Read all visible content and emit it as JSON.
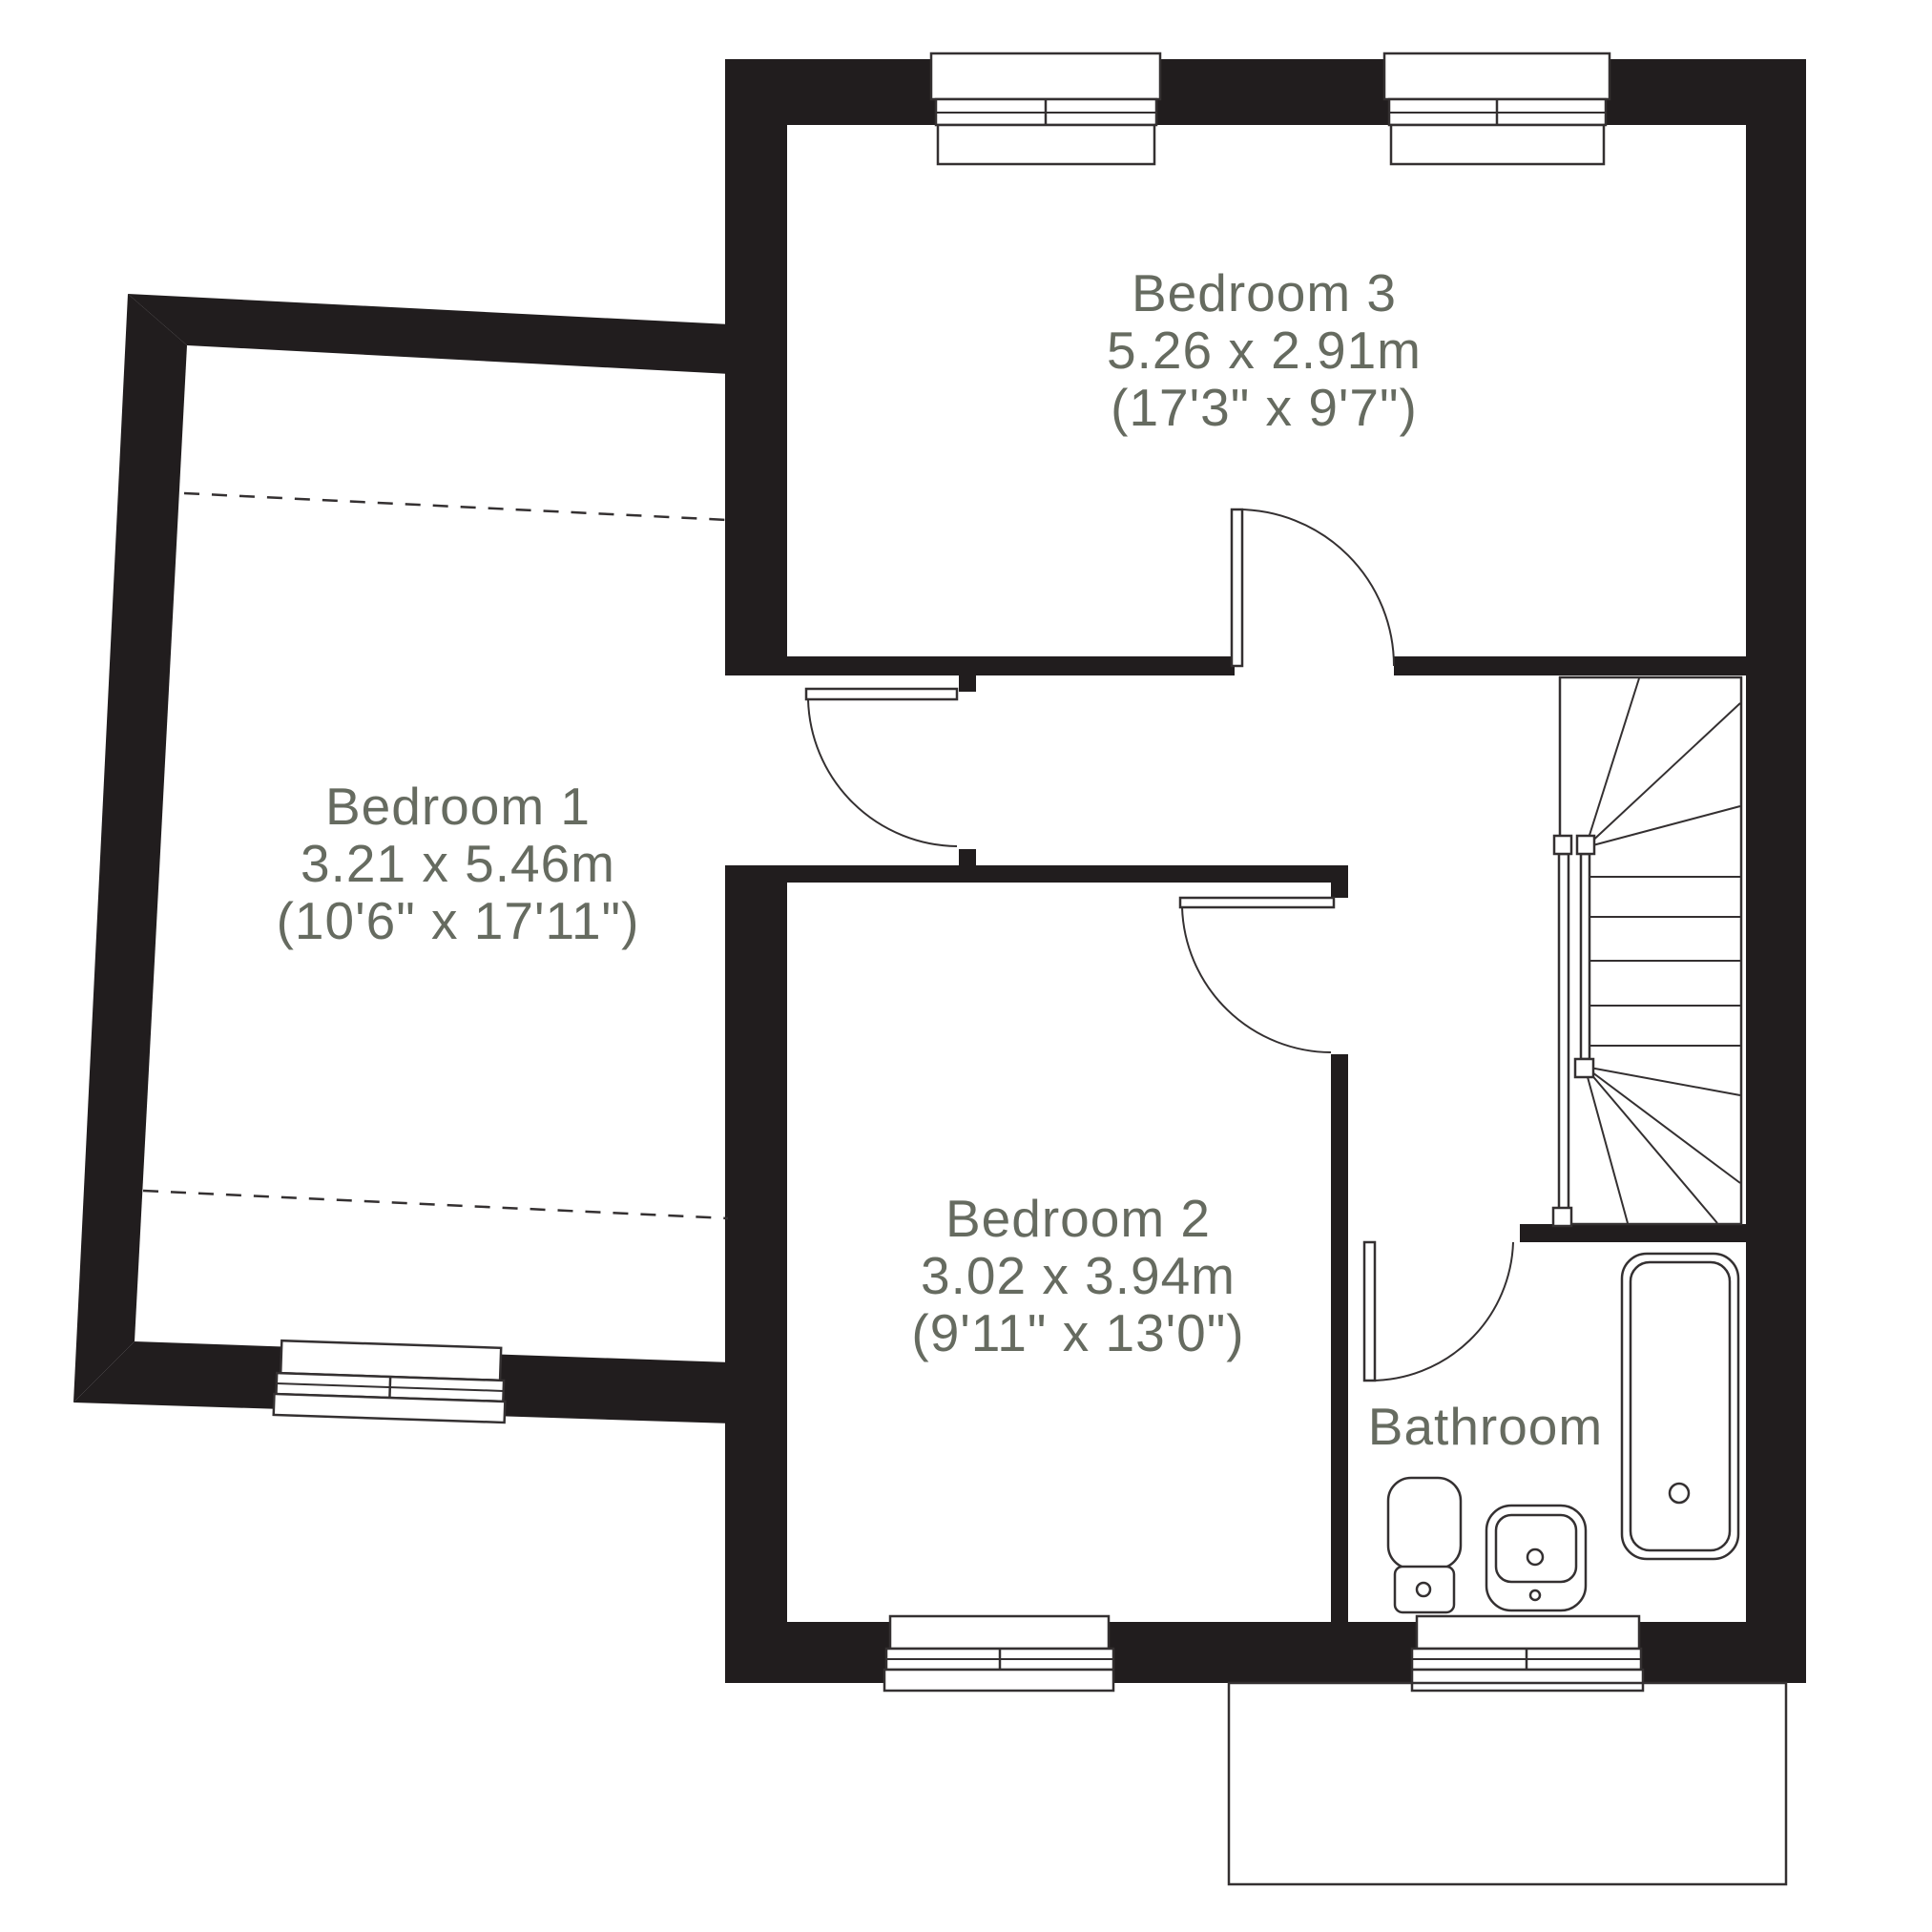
{
  "title": "First floor plan",
  "palette": {
    "wall": "#211d1e",
    "line": "#343031",
    "label": "#666b60"
  },
  "rooms": {
    "bedroom1": {
      "name": "Bedroom 1",
      "dimensions_metric": "3.21 x 5.46m",
      "dimensions_imperial": "(10'6\" x 17'11\")"
    },
    "bedroom2": {
      "name": "Bedroom 2",
      "dimensions_metric": "3.02 x 3.94m",
      "dimensions_imperial": "(9'11\" x 13'0\")"
    },
    "bedroom3": {
      "name": "Bedroom 3",
      "dimensions_metric": "5.26 x 2.91m",
      "dimensions_imperial": "(17'3\" x 9'7\")"
    },
    "bathroom": {
      "name": "Bathroom"
    }
  }
}
